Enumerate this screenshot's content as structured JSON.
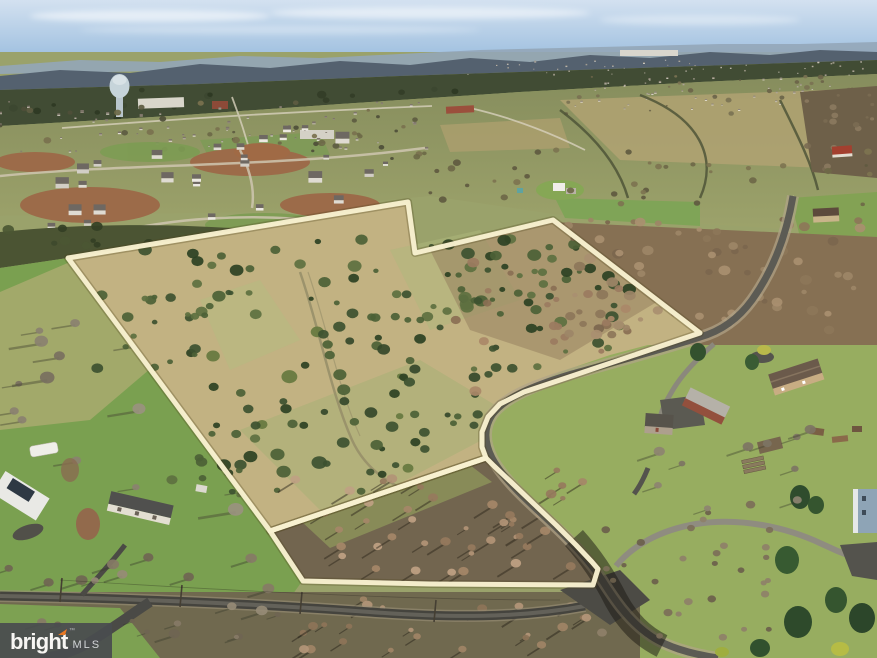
{
  "scene": {
    "description": "Aerial drone photo of a wooded/brush acreage parcel outlined in cream-white, with suburban development, town, water tower and mountain ridge in the distance, rural homes and roads in the foreground",
    "palette": {
      "sky_top": "#d3e1f0",
      "sky_horizon": "#a8c6e3",
      "ridge_far": "#93a6b8",
      "ridge_near": "#54616f",
      "forest_band": "#414c34",
      "valley_green": "#8b9162",
      "field_tan": "#b0a272",
      "parcel_grass": "#c2b282",
      "cedar_green": "#41552f",
      "pasture_green": "#7aa050",
      "lawn_green": "#97ad60",
      "dirt_red": "#9c6b49",
      "road_dark": "#45443e",
      "road_light": "#8f8c80",
      "outline_cream": "#f8f1d0",
      "watermark_orange": "#e87722",
      "watermark_gray": "#4c4f52"
    }
  },
  "outline": {
    "stroke_color": "#f8f1d0",
    "main_points": "68,258 408,202 415,253 553,220 700,333 560,380 524,392 500,404 488,417 482,432 482,447 486,458 270,531",
    "front_points": "270,531 486,458 494,466 512,483 535,505 556,525 576,545 592,562 598,569 593,585 430,584 303,581"
  },
  "watermark": {
    "brand": "bright",
    "tm": "™",
    "suffix": "MLS",
    "accent_color": "#e87722"
  },
  "scatter": [
    {
      "target": "g-forest",
      "region": [
        0,
        88,
        877,
        32
      ],
      "count": 46,
      "rmin": 2,
      "rmax": 5,
      "colors": [
        "#333d27",
        "#3c4730",
        "#2e3823"
      ],
      "shape": "tree",
      "seed": 11
    },
    {
      "target": "g-town-houses",
      "region": [
        0,
        100,
        430,
        54
      ],
      "count": 64,
      "rmin": 1.5,
      "rmax": 3.5,
      "colors": [
        "#e9e5dc",
        "#d8d2c6",
        "#b9b1a4",
        "#93897c"
      ],
      "shape": "house",
      "roof": "#7e756a",
      "seed": 21
    },
    {
      "target": "g-town-trees",
      "region": [
        0,
        100,
        434,
        60
      ],
      "count": 42,
      "rmin": 1.5,
      "rmax": 4,
      "colors": [
        "#5d5b41",
        "#6c6946",
        "#79714e",
        "#4e4e38"
      ],
      "shape": "tree",
      "seed": 31
    },
    {
      "target": "g-devfar-a",
      "region": [
        450,
        60,
        420,
        16
      ],
      "count": 48,
      "rmin": 1,
      "rmax": 2,
      "colors": [
        "#efeae0",
        "#ddd6c8",
        "#c9c1b1"
      ],
      "shape": "house",
      "roof": "#9a9183",
      "seed": 41
    },
    {
      "target": "g-devfar-b",
      "region": [
        556,
        78,
        300,
        34
      ],
      "count": 55,
      "rmin": 1.3,
      "rmax": 2.6,
      "colors": [
        "#efeae0",
        "#ddd6c8",
        "#c9c1b1"
      ],
      "shape": "house",
      "roof": "#8f8679",
      "seed": 51
    },
    {
      "target": "g-fartrees",
      "region": [
        560,
        76,
        300,
        38
      ],
      "count": 28,
      "rmin": 1,
      "rmax": 3,
      "colors": [
        "#6b6449",
        "#7a7252"
      ],
      "shape": "tree",
      "seed": 61
    },
    {
      "target": "g-midtrees",
      "region": [
        430,
        150,
        440,
        56
      ],
      "count": 36,
      "rmin": 1.5,
      "rmax": 4,
      "colors": [
        "#5f5a40",
        "#6e6848",
        "#7d7450"
      ],
      "shape": "tree",
      "seed": 71
    },
    {
      "target": "g-dev-houses",
      "region": [
        12,
        138,
        390,
        90
      ],
      "count": 20,
      "rmin": 7,
      "rmax": 14,
      "colors": [
        "#ece9e2",
        "#dfdbd2",
        "#d2cec6"
      ],
      "shape": "house",
      "roof": "#6e6862",
      "seed": 81
    },
    {
      "target": "g-dev-houses",
      "region": [
        200,
        128,
        210,
        36
      ],
      "count": 8,
      "rmin": 5,
      "rmax": 9,
      "colors": [
        "#ece9e2",
        "#e0dcd3"
      ],
      "shape": "house",
      "roof": "#6e6862",
      "seed": 91
    },
    {
      "target": "g-leftwoods",
      "region": [
        0,
        222,
        350,
        58
      ],
      "count": 40,
      "rmin": 2.5,
      "rmax": 6,
      "colors": [
        "#3e4a2c",
        "#4b5733",
        "#333f24"
      ],
      "shape": "tree",
      "seed": 101
    },
    {
      "target": "g-pasture",
      "region": [
        4,
        310,
        240,
        215
      ],
      "count": 16,
      "rmin": 3.5,
      "rmax": 8,
      "colors": [
        "#8a8170",
        "#99917f",
        "#78705f"
      ],
      "shape": "tree",
      "shadow": {
        "dx": -2.2,
        "dy": 0.35,
        "color": "rgba(70,72,52,0.45)"
      },
      "seed": 111
    },
    {
      "target": "g-cedar-top",
      "region": [
        140,
        238,
        500,
        80
      ],
      "count": 60,
      "rmin": 2.5,
      "rmax": 7,
      "colors": [
        "#3d5130",
        "#4c6136",
        "#2c4123",
        "#5d7040"
      ],
      "shape": "tree",
      "seed": 121
    },
    {
      "target": "g-cedar-mid",
      "region": [
        190,
        330,
        240,
        170
      ],
      "count": 40,
      "rmin": 3,
      "rmax": 8,
      "colors": [
        "#3d5130",
        "#4c6136",
        "#2c4123",
        "#66783f"
      ],
      "shape": "tree",
      "seed": 131
    },
    {
      "target": "g-cedar-band2",
      "region": [
        320,
        300,
        200,
        150
      ],
      "count": 34,
      "rmin": 3,
      "rmax": 7,
      "colors": [
        "#3d5130",
        "#4c6136",
        "#35482a"
      ],
      "shape": "tree",
      "seed": 141
    },
    {
      "target": "g-cedar-right",
      "region": [
        430,
        240,
        210,
        130
      ],
      "count": 40,
      "rmin": 2.5,
      "rmax": 7,
      "colors": [
        "#3d5130",
        "#4c6136",
        "#2c4123",
        "#5d7040"
      ],
      "shape": "tree",
      "seed": 151
    },
    {
      "target": "g-brushpink",
      "region": [
        440,
        255,
        220,
        140
      ],
      "count": 26,
      "rmin": 3,
      "rmax": 6,
      "colors": [
        "#9b7b5f",
        "#aa8868",
        "#8a6f54"
      ],
      "shape": "tree",
      "seed": 161
    },
    {
      "target": "g-edge1",
      "region": [
        90,
        280,
        120,
        90
      ],
      "count": 14,
      "rmin": 2.5,
      "rmax": 6,
      "colors": [
        "#3d5130",
        "#4c6136",
        "#5d7040"
      ],
      "shape": "tree",
      "seed": 171
    },
    {
      "target": "g-edge2",
      "region": [
        170,
        390,
        110,
        110
      ],
      "count": 14,
      "rmin": 2.5,
      "rmax": 6,
      "colors": [
        "#3d5130",
        "#4c6136",
        "#5d7040"
      ],
      "shape": "tree",
      "seed": 181
    },
    {
      "target": "g-rightwoods",
      "region": [
        560,
        215,
        310,
        122
      ],
      "count": 70,
      "rmin": 2.5,
      "rmax": 6,
      "colors": [
        "#8d7659",
        "#9d8567",
        "#7c664e",
        "#a98f70"
      ],
      "shape": "tree",
      "seed": 191
    },
    {
      "target": "g-frontlot",
      "region": [
        295,
        468,
        290,
        106
      ],
      "count": 44,
      "rmin": 2.5,
      "rmax": 5.5,
      "colors": [
        "#b29476",
        "#a58768",
        "#967a5d",
        "#bfa183"
      ],
      "shape": "tree",
      "shadow": {
        "dx": -1.6,
        "dy": 1.0,
        "color": "rgba(45,40,28,0.5)"
      },
      "seed": 201
    },
    {
      "target": "g-bottomstrip",
      "region": [
        300,
        598,
        300,
        54
      ],
      "count": 26,
      "rmin": 2.5,
      "rmax": 5.5,
      "colors": [
        "#a08466",
        "#8d7458",
        "#b39678"
      ],
      "shape": "tree",
      "shadow": {
        "dx": -1.4,
        "dy": 0.9,
        "color": "rgba(40,36,26,0.5)"
      },
      "seed": 211
    },
    {
      "target": "g-roadBbare",
      "region": [
        600,
        500,
        170,
        140
      ],
      "count": 30,
      "rmin": 2,
      "rmax": 5,
      "colors": [
        "#7c6e59",
        "#8e8069",
        "#6b5f4c"
      ],
      "shape": "tree",
      "seed": 221
    },
    {
      "target": "g-rightlawn-trees",
      "region": [
        640,
        420,
        180,
        90
      ],
      "count": 10,
      "rmin": 3,
      "rmax": 6,
      "colors": [
        "#7d7464",
        "#8d8371"
      ],
      "shape": "tree",
      "shadow": {
        "dx": -1.8,
        "dy": 0.6,
        "color": "rgba(60,62,45,0.4)"
      },
      "seed": 231
    },
    {
      "target": "g-bottomleft-trees",
      "region": [
        0,
        556,
        300,
        82
      ],
      "count": 22,
      "rmin": 2.5,
      "rmax": 6,
      "colors": [
        "#857a66",
        "#968b76",
        "#6f6552"
      ],
      "shape": "tree",
      "shadow": {
        "dx": -1.6,
        "dy": 0.5,
        "color": "rgba(55,57,42,0.4)"
      },
      "seed": 241
    },
    {
      "target": "g-rightedge-bare",
      "region": [
        804,
        94,
        70,
        76
      ],
      "count": 16,
      "rmin": 1.5,
      "rmax": 4,
      "colors": [
        "#7a6b52",
        "#8a7a5f"
      ],
      "shape": "tree",
      "seed": 251
    }
  ]
}
